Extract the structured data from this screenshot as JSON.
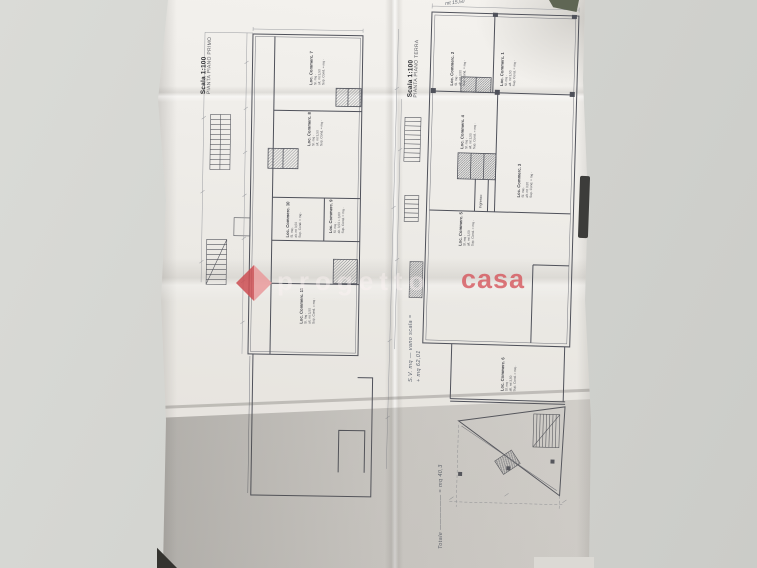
{
  "watermark": {
    "prefix": "progetto",
    "brand": "casa",
    "diamond_dark": "#cc4d52",
    "diamond_light": "#e99a9b"
  },
  "left_plan": {
    "title": "PIANTA PIANO PRIMO",
    "scale": "Scala 1:100",
    "rooms": [
      {
        "name": "Loc. Commerc. 7",
        "details": "Sl. mq ·\nalt. mt 3,50\nSup. Cond. = mq ·"
      },
      {
        "name": "Loc. Commerc. 8",
        "details": "Sl. mq ·\nalt. mt 3,50\nSup. Cond. = mq ·"
      },
      {
        "name": "Loc. Commerc. 9",
        "details": "Sl. mq ·\nalt. 3,50 + 3,60\nSup. Cond. = mq ·"
      },
      {
        "name": "Loc. Commerc. 10",
        "details": "Sl. mq ·\nalt. mt 3,50\nSup. Cond. = mq ·"
      },
      {
        "name": "Loc. Commerc. 11",
        "details": "Sl. mq ·\nalt. mt 3,50\nSup. Cond. = mq ·"
      }
    ]
  },
  "right_plan": {
    "title": "PIANTA PIANO TERRA",
    "scale": "Scala 1:100",
    "ingresso": "Ingresso",
    "top_note": "mt 15,50",
    "rooms": [
      {
        "name": "Loc. Commerc. 1",
        "details": "Sl. mq ·\nalt. mt 3,50\nSup. Cond. = mq ·"
      },
      {
        "name": "Loc. Commerc. 2",
        "details": "Sl. mq ·\nalt. mt 3,50\nSup. Cond. = mq ·"
      },
      {
        "name": "Loc. Commerc. 3",
        "details": "Sl. mq ·\nalt. mt 3,50\nSup. Cond. = mq ·"
      },
      {
        "name": "Loc. Commerc. 4",
        "details": "Sl. mq ·\nalt. mt 3,50\nSup. Cond. = mq ·"
      },
      {
        "name": "Loc. Commerc. 5",
        "details": "Sl. mq ·\nalt. mt 3,50\nSup. Cond. = mq ·"
      },
      {
        "name": "Loc. Commerc. 6",
        "details": "Sl. mq ·\nalt. mt 3,50\nSup. Cond. = mq ·"
      }
    ]
  },
  "annotations": {
    "side_note_line1": "S.V. mq — vano scala =",
    "side_note_line2": "+ mq 62,01",
    "total_note": "Totale —————— = mq 40,3"
  }
}
